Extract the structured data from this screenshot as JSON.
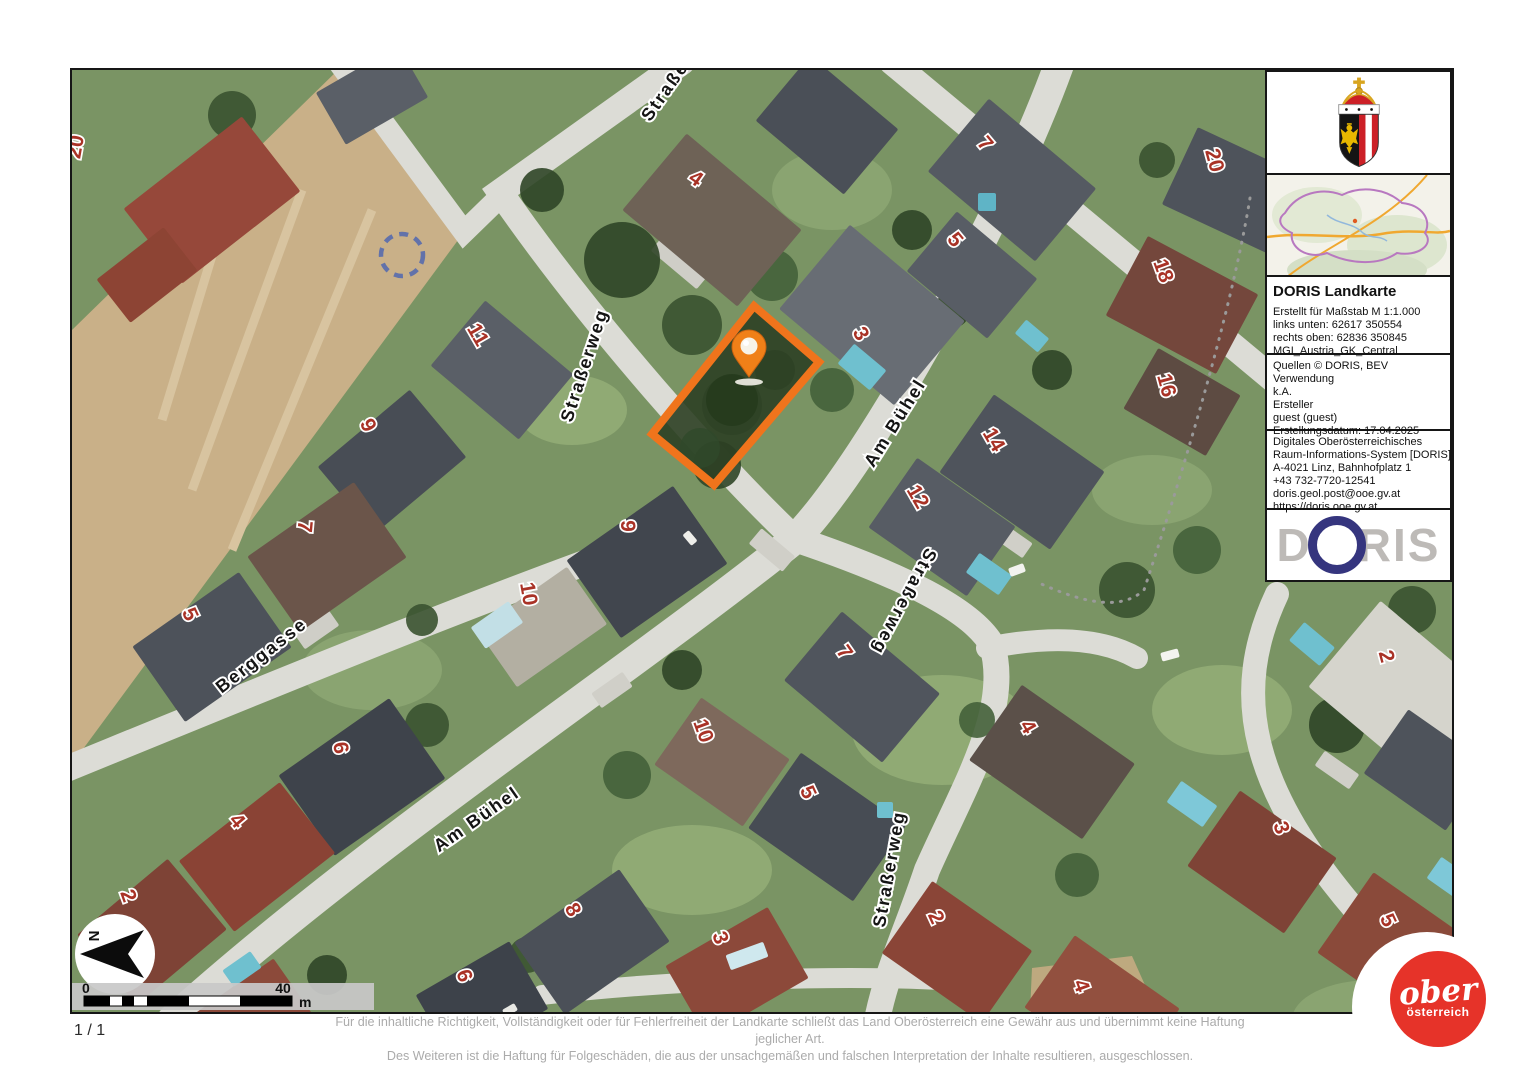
{
  "page": {
    "page_indicator": "1 / 1",
    "disclaimer_line1": "Für die inhaltliche Richtigkeit, Vollständigkeit oder für Fehlerfreiheit der Landkarte schließt das Land Oberösterreich eine Gewähr aus und übernimmt keine Haftung jeglicher Art.",
    "disclaimer_line2": "Des Weiteren ist die Haftung für Folgeschäden, die aus der unsachgemäßen und falschen Interpretation der Inhalte resultieren, ausgeschlossen."
  },
  "sidebar": {
    "title": "DORIS Landkarte",
    "meta_lines": [
      "Erstellt für Maßstab M 1:1.000",
      "links unten: 62617 350554",
      "rechts oben: 62836 350845",
      "MGI_Austria_GK_Central"
    ],
    "source_lines": [
      "Quellen © DORIS, BEV",
      "Verwendung",
      "k.A.",
      "Ersteller",
      "guest (guest)",
      "Erstellungsdatum: 17.04.2025"
    ],
    "contact_lines": [
      "Digitales Oberösterreichisches",
      "Raum-Informations-System [DORIS]",
      "A-4021 Linz, Bahnhofplatz 1",
      "+43 732-7720-12541",
      "doris.geol.post@ooe.gv.at",
      "https://doris.ooe.gv.at"
    ],
    "doris_logo": {
      "d": "D",
      "ris": "RIS"
    }
  },
  "map": {
    "north_label": "N",
    "scale_bar": {
      "start": "0",
      "end": "40",
      "unit": "m"
    },
    "colors": {
      "highlight_orange": "#f0741c",
      "marker_orange": "#f08018",
      "house_number_red": "#a93226",
      "road_gray": "#dcdcd6",
      "field_tan": "#c9b088"
    },
    "street_labels": [
      {
        "label": "Straßerweg",
        "x": 518,
        "y": 297,
        "rot": -72
      },
      {
        "label": "Am Bühel",
        "x": 828,
        "y": 356,
        "rot": -58
      },
      {
        "label": "Berggasse",
        "x": 193,
        "y": 590,
        "rot": -38
      },
      {
        "label": "Am Bühel",
        "x": 408,
        "y": 754,
        "rot": -35
      },
      {
        "label": "Straßerweg",
        "x": 827,
        "y": 529,
        "rot": 118
      },
      {
        "label": "Straßerweg",
        "x": 823,
        "y": 800,
        "rot": -80
      },
      {
        "label": "Straßerweg",
        "x": 612,
        "y": 4,
        "rot": -55
      }
    ],
    "house_numbers": [
      {
        "label": "20",
        "x": 10,
        "y": 78,
        "rot": -80
      },
      {
        "label": "4",
        "x": 620,
        "y": 114,
        "rot": 35
      },
      {
        "label": "7",
        "x": 908,
        "y": 78,
        "rot": 50
      },
      {
        "label": "20",
        "x": 1136,
        "y": 92,
        "rot": 75
      },
      {
        "label": "5",
        "x": 878,
        "y": 174,
        "rot": 50
      },
      {
        "label": "18",
        "x": 1085,
        "y": 203,
        "rot": 70
      },
      {
        "label": "11",
        "x": 400,
        "y": 268,
        "rot": 60
      },
      {
        "label": "3",
        "x": 783,
        "y": 267,
        "rot": 60
      },
      {
        "label": "16",
        "x": 1088,
        "y": 317,
        "rot": 75
      },
      {
        "label": "9",
        "x": 290,
        "y": 358,
        "rot": 65
      },
      {
        "label": "14",
        "x": 916,
        "y": 373,
        "rot": 60
      },
      {
        "label": "12",
        "x": 840,
        "y": 430,
        "rot": 60
      },
      {
        "label": "7",
        "x": 226,
        "y": 456,
        "rot": 95
      },
      {
        "label": "9",
        "x": 549,
        "y": 456,
        "rot": 90
      },
      {
        "label": "10",
        "x": 450,
        "y": 525,
        "rot": 80
      },
      {
        "label": "5",
        "x": 112,
        "y": 547,
        "rot": 65
      },
      {
        "label": "7",
        "x": 767,
        "y": 586,
        "rot": 55
      },
      {
        "label": "2",
        "x": 1308,
        "y": 588,
        "rot": 75
      },
      {
        "label": "10",
        "x": 625,
        "y": 663,
        "rot": 70
      },
      {
        "label": "4",
        "x": 950,
        "y": 660,
        "rot": 60
      },
      {
        "label": "6",
        "x": 262,
        "y": 679,
        "rot": 80
      },
      {
        "label": "5",
        "x": 730,
        "y": 725,
        "rot": 65
      },
      {
        "label": "4",
        "x": 160,
        "y": 755,
        "rot": 50
      },
      {
        "label": "3",
        "x": 1203,
        "y": 760,
        "rot": 70
      },
      {
        "label": "8",
        "x": 495,
        "y": 843,
        "rot": 60
      },
      {
        "label": "2",
        "x": 50,
        "y": 828,
        "rot": 70
      },
      {
        "label": "2",
        "x": 858,
        "y": 850,
        "rot": 65
      },
      {
        "label": "3",
        "x": 642,
        "y": 870,
        "rot": 70
      },
      {
        "label": "6",
        "x": 386,
        "y": 908,
        "rot": 70
      },
      {
        "label": "5",
        "x": 1310,
        "y": 853,
        "rot": 65
      },
      {
        "label": "4",
        "x": 1003,
        "y": 918,
        "rot": 70
      }
    ]
  },
  "footer_logo": {
    "line1": "ober",
    "line2": "österreich"
  }
}
